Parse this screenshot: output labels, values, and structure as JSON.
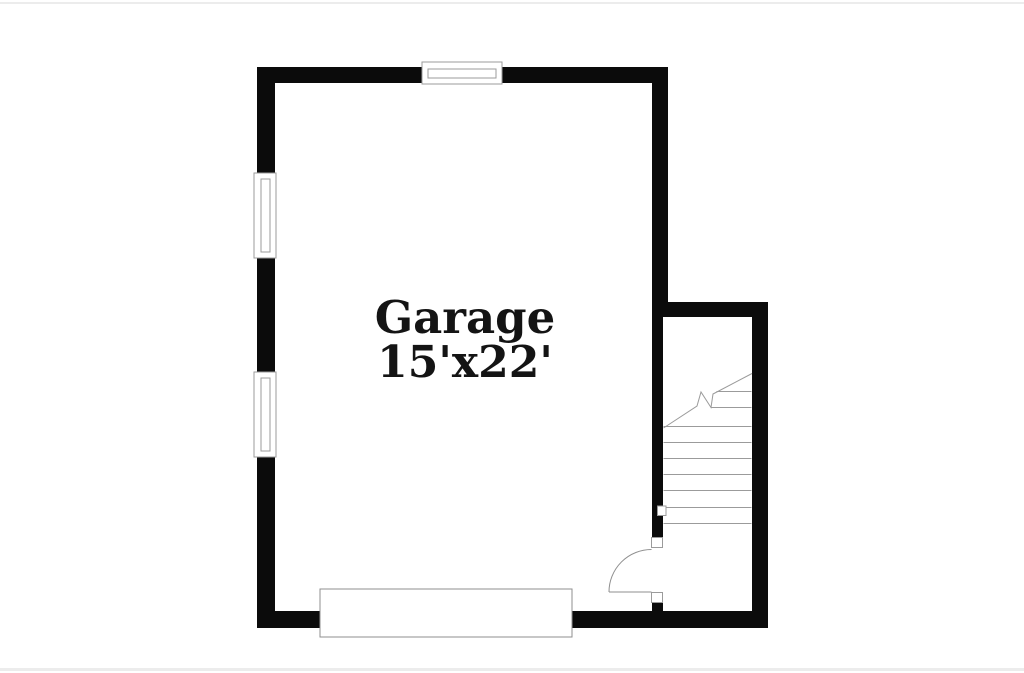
{
  "floorplan": {
    "room": {
      "name": "Garage",
      "size": "15'x22'"
    },
    "colors": {
      "wall": "#0b0b0b",
      "fixture_line": "#9b9b9b",
      "door_line": "#8f8f8f",
      "text": "#141414",
      "frame": "#ececec"
    },
    "elements": [
      "top-window",
      "left-window-upper",
      "left-window-lower",
      "staircase",
      "stair-break-line",
      "entry-door-swing",
      "garage-door"
    ]
  }
}
